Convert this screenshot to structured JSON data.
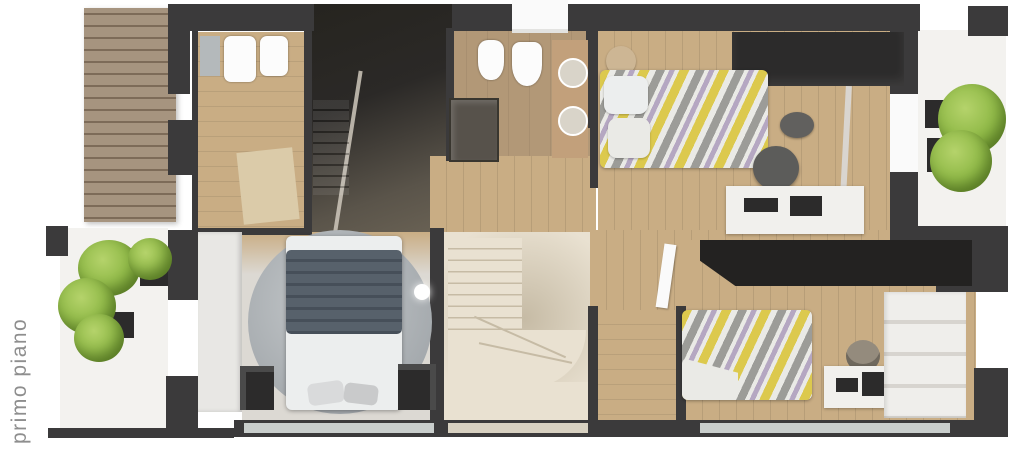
{
  "label": {
    "text": "primo piano"
  },
  "colors": {
    "wall": "#3b3a3b",
    "wall_deep": "#232221",
    "void_dark": "#26241f",
    "void_light": "#5a544a",
    "wood": "#c9ad84",
    "wood_dark": "#b2946c",
    "tile": "#b29877",
    "floor_light": "#dcd9d3",
    "white_floor": "#f3f2ef",
    "stair_cream": "#e9e1d1",
    "stair_line": "#c6bba5",
    "rug_light": "#c6cacc",
    "rug": "#a3a8ac",
    "duvet": "#57616b",
    "duvet_dark": "#464f59",
    "bed_white": "#eceeee",
    "chev_y": "#dcc94d",
    "chev_g": "#9c9c98",
    "chev_w": "#eaeae6",
    "chev_l": "#b5a7c2",
    "plant": "#7fae37",
    "plant_light": "#b5d36b",
    "pergola_a": "#a6947f",
    "pergola_b": "#7d6b58",
    "fixture": "#fcfcfc",
    "desk": "#f1f0ed",
    "furn_dark": "#2c2b2b",
    "glass": "#c9cecc",
    "beige_glass": "#d8d1c1",
    "label_grey": "#8e8e8e",
    "appliance": "#b4b9bb",
    "mat": "#dbcba9",
    "vanity": "#c2a07b",
    "basin": "#d9d4c9",
    "shelf": "#efeeeb",
    "shelf_line": "#d7d4cf",
    "door_white": "#fafafa"
  }
}
